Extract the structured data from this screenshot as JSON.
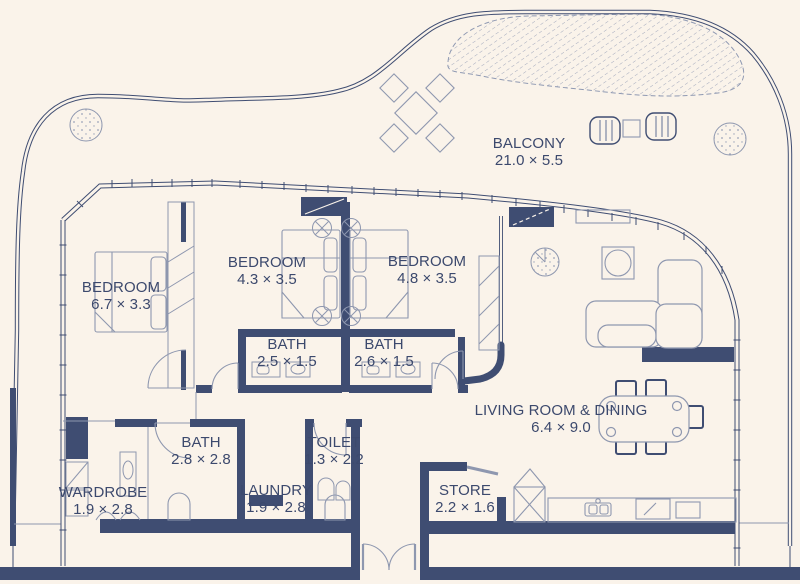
{
  "colors": {
    "background": "#faf3ea",
    "wall_navy": "#3f4d72",
    "text_navy": "#3c496d",
    "furniture_line": "#8e97af",
    "hatch_line": "#9aa2b8"
  },
  "rooms": [
    {
      "name": "BALCONY",
      "dims": "21.0 × 5.5"
    },
    {
      "name": "BEDROOM",
      "dims": "6.7 × 3.3"
    },
    {
      "name": "BEDROOM",
      "dims": "4.3 × 3.5"
    },
    {
      "name": "BEDROOM",
      "dims": "4.8 × 3.5"
    },
    {
      "name": "BATH",
      "dims": "2.5 × 1.5"
    },
    {
      "name": "BATH",
      "dims": "2.6 × 1.5"
    },
    {
      "name": "BATH",
      "dims": "2.8 × 2.8"
    },
    {
      "name": "TOILET",
      "dims": "1.3 × 2.2"
    },
    {
      "name": "WARDROBE",
      "dims": "1.9 × 2.8"
    },
    {
      "name": "LAUNDRY",
      "dims": "1.9 × 2.8"
    },
    {
      "name": "STORE",
      "dims": "2.2 × 1.6"
    },
    {
      "name": "LIVING ROOM & DINING",
      "dims": "6.4 × 9.0"
    }
  ],
  "icons": [
    "bed-icon",
    "sofa-icon",
    "dining-table-icon",
    "kitchen-counter-icon",
    "fridge-icon",
    "toilet-icon",
    "sink-icon",
    "washer-icon",
    "wardrobe-icon",
    "plant-icon",
    "planter-icon",
    "sun-lounger-icon",
    "outdoor-table-icon",
    "tv-console-icon",
    "door-swing-icon",
    "window-wall-icon",
    "planting-hatch-area"
  ]
}
